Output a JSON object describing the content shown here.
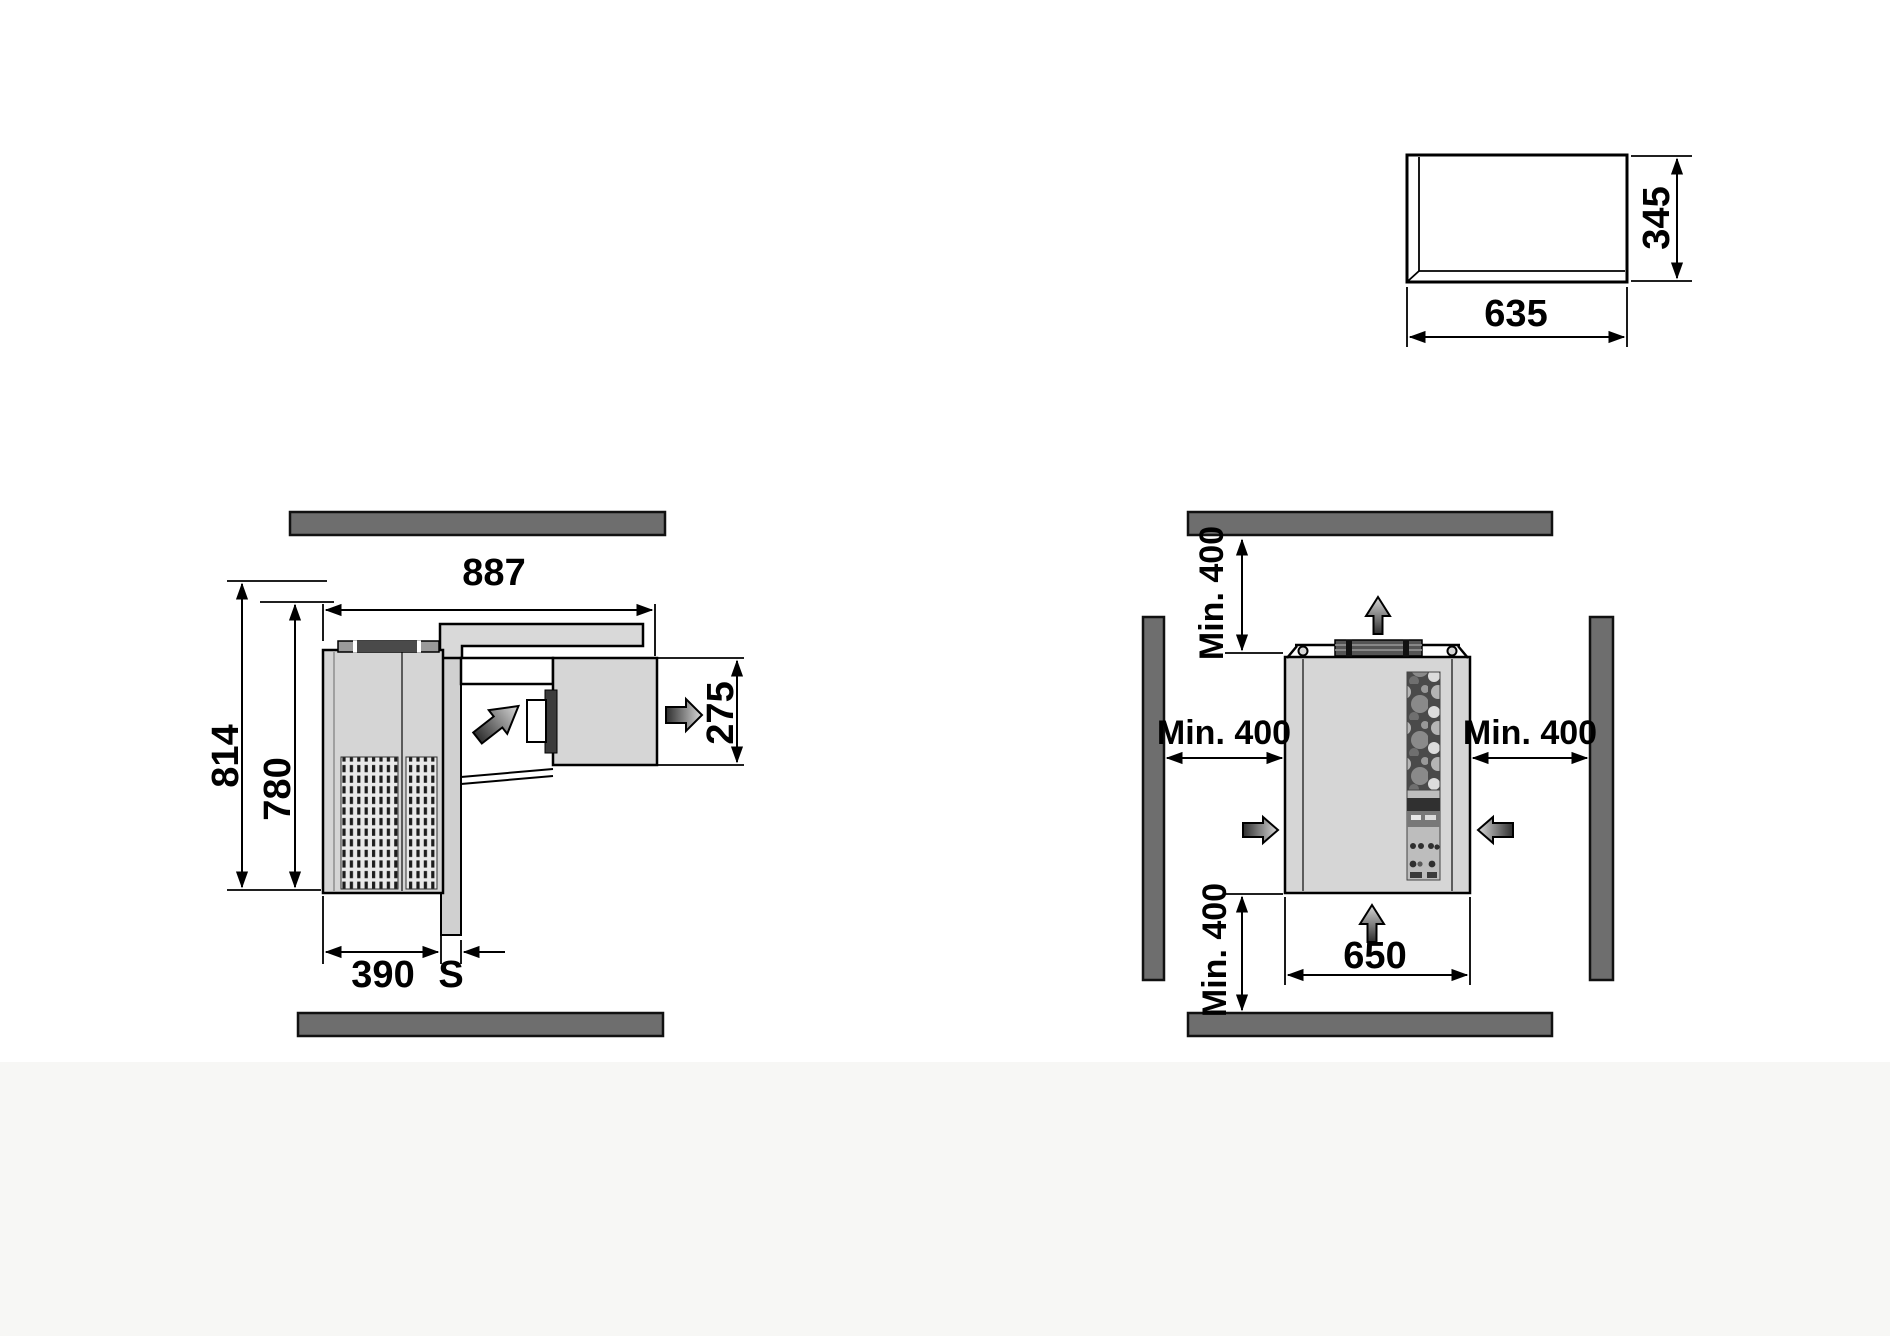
{
  "drawing": {
    "side_view": {
      "dim_total_depth": "887",
      "dim_total_height": "814",
      "dim_body_height": "780",
      "dim_body_depth": "390",
      "dim_wall_thickness": "S",
      "dim_evaporator_height": "275"
    },
    "top_view": {
      "clearance_top": "Min. 400",
      "clearance_left": "Min. 400",
      "clearance_right": "Min. 400",
      "clearance_bottom": "Min. 400",
      "dim_unit_width": "650"
    },
    "front_view": {
      "dim_width": "635",
      "dim_height": "345"
    },
    "colors": {
      "wall_fill": "#6e6e6e",
      "panel_fill": "#d6d6d6",
      "line": "#000000"
    },
    "icons": [
      "airflow-up-arrow-top",
      "airflow-up-arrow-bottom",
      "airflow-right-arrow",
      "airflow-left-arrow",
      "airflow-diagonal-arrow",
      "airflow-exhaust-arrow"
    ]
  }
}
